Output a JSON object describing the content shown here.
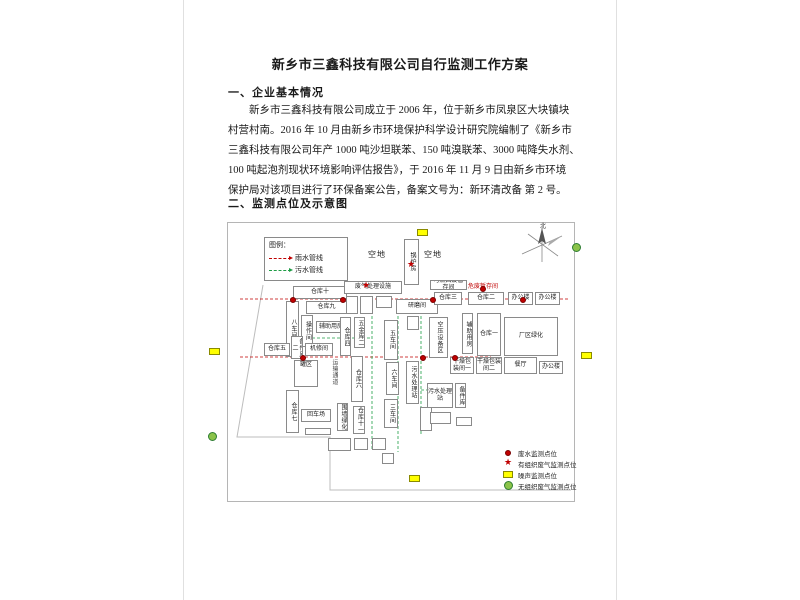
{
  "document": {
    "title": "新乡市三鑫科技有限公司自行监测工作方案",
    "section1_heading": "一、企业基本情况",
    "paragraph_lines": [
      "新乡市三鑫科技有限公司成立于 2006 年，位于新乡市凤泉区大块镇块",
      "村营村南。2016 年 10 月由新乡市环境保护科学设计研究院编制了《新乡市",
      "三鑫科技有限公司年产 1000 吨沙坦联苯、150 吨溴联苯、3000 吨降失水剂、",
      "100 吨起泡剂现状环境影响评估报告》，于 2016 年 11 月 9 日由新乡市环境",
      "保护局对该项目进行了环保备案公告，备案文号为：新环清改备 第 2 号。"
    ],
    "section2_heading": "二、监测点位及示意图"
  },
  "colors": {
    "red": "#c00000",
    "green": "#1f9d46",
    "yellow": "#ffff00",
    "boundary": "#bdbdbd"
  },
  "diagram": {
    "compass_label": "北",
    "pipe_legend": {
      "title": "图例：",
      "items": [
        {
          "color": "red",
          "label": "雨水管线"
        },
        {
          "color": "green",
          "label": "污水管线"
        }
      ]
    },
    "areas": [
      {
        "label": "空地",
        "x": 368,
        "y": 249
      },
      {
        "label": "空地",
        "x": 424,
        "y": 249
      }
    ],
    "red_label": {
      "label": "危废暂存间",
      "x": 468,
      "y": 281
    },
    "buildings": [
      {
        "label": "锅炉房",
        "x": 404,
        "y": 239,
        "w": 15,
        "h": 46,
        "v": 1
      },
      {
        "label": "仓库十",
        "x": 293,
        "y": 286,
        "w": 54,
        "h": 13
      },
      {
        "label": "仓库九",
        "x": 306,
        "y": 301,
        "w": 41,
        "h": 13
      },
      {
        "label": "八车间",
        "x": 286,
        "y": 301,
        "w": 13,
        "h": 56,
        "v": 1
      },
      {
        "label": "操作间",
        "x": 301,
        "y": 315,
        "w": 12,
        "h": 32,
        "v": 1
      },
      {
        "label": "辅助用房",
        "x": 316,
        "y": 321,
        "w": 30,
        "h": 12
      },
      {
        "label": "仓库五",
        "x": 264,
        "y": 343,
        "w": 26,
        "h": 13
      },
      {
        "label": "备件库二",
        "x": 291,
        "y": 336,
        "w": 12,
        "h": 23,
        "v": 1
      },
      {
        "label": "机修间",
        "x": 305,
        "y": 343,
        "w": 28,
        "h": 13
      },
      {
        "label": "罐区",
        "x": 294,
        "y": 360,
        "w": 24,
        "h": 27,
        "tank": 1
      },
      {
        "label": "运输通道",
        "x": 329,
        "y": 352,
        "w": 9,
        "h": 40,
        "v": 1,
        "road": 1
      },
      {
        "label": "仓库六",
        "x": 351,
        "y": 356,
        "w": 12,
        "h": 46,
        "v": 1
      },
      {
        "label": "仓库七",
        "x": 286,
        "y": 390,
        "w": 13,
        "h": 43,
        "v": 1
      },
      {
        "label": "回车场",
        "x": 301,
        "y": 409,
        "w": 30,
        "h": 13
      },
      {
        "label": "围墙绿化",
        "x": 337,
        "y": 403,
        "w": 11,
        "h": 28,
        "v": 1
      },
      {
        "label": "仓库十一",
        "x": 353,
        "y": 406,
        "w": 12,
        "h": 28,
        "v": 1
      },
      {
        "label": "废气处理设施",
        "x": 344,
        "y": 281,
        "w": 58,
        "h": 13
      },
      {
        "label": "",
        "x": 346,
        "y": 296,
        "w": 12,
        "h": 18
      },
      {
        "label": "",
        "x": 360,
        "y": 296,
        "w": 13,
        "h": 18
      },
      {
        "label": "",
        "x": 376,
        "y": 296,
        "w": 16,
        "h": 12
      },
      {
        "label": "研磨间",
        "x": 396,
        "y": 299,
        "w": 42,
        "h": 15
      },
      {
        "label": "",
        "x": 407,
        "y": 316,
        "w": 12,
        "h": 14
      },
      {
        "label": "仓库四",
        "x": 340,
        "y": 317,
        "w": 11,
        "h": 39,
        "v": 1
      },
      {
        "label": "五金库二",
        "x": 354,
        "y": 317,
        "w": 11,
        "h": 31,
        "v": 1
      },
      {
        "label": "五车间",
        "x": 384,
        "y": 320,
        "w": 14,
        "h": 40,
        "v": 1
      },
      {
        "label": "空压设备区",
        "x": 429,
        "y": 317,
        "w": 19,
        "h": 41,
        "v": 1
      },
      {
        "label": "六车间",
        "x": 386,
        "y": 362,
        "w": 13,
        "h": 33,
        "v": 1
      },
      {
        "label": "污水处理站",
        "x": 406,
        "y": 361,
        "w": 13,
        "h": 43,
        "v": 1
      },
      {
        "label": "三车间",
        "x": 384,
        "y": 399,
        "w": 14,
        "h": 29,
        "v": 1
      },
      {
        "label": "",
        "x": 420,
        "y": 407,
        "w": 12,
        "h": 24,
        "v": 1
      },
      {
        "label": "可燃固废暂存间",
        "x": 430,
        "y": 280,
        "w": 37,
        "h": 10
      },
      {
        "label": "仓库三",
        "x": 434,
        "y": 292,
        "w": 28,
        "h": 13
      },
      {
        "label": "仓库二",
        "x": 468,
        "y": 292,
        "w": 36,
        "h": 13
      },
      {
        "label": "办公楼",
        "x": 508,
        "y": 292,
        "w": 25,
        "h": 13
      },
      {
        "label": "办公楼",
        "x": 535,
        "y": 292,
        "w": 25,
        "h": 13
      },
      {
        "label": "辅助用房",
        "x": 462,
        "y": 313,
        "w": 11,
        "h": 41,
        "v": 1
      },
      {
        "label": "仓库一",
        "x": 477,
        "y": 313,
        "w": 24,
        "h": 43
      },
      {
        "label": "厂区绿化",
        "x": 504,
        "y": 317,
        "w": 54,
        "h": 39
      },
      {
        "label": "干燥包装间一",
        "x": 450,
        "y": 357,
        "w": 24,
        "h": 17
      },
      {
        "label": "干燥包装间二",
        "x": 476,
        "y": 357,
        "w": 26,
        "h": 17
      },
      {
        "label": "餐厅",
        "x": 504,
        "y": 357,
        "w": 33,
        "h": 17
      },
      {
        "label": "办公楼",
        "x": 539,
        "y": 361,
        "w": 24,
        "h": 13
      },
      {
        "label": "污水处理站",
        "x": 427,
        "y": 383,
        "w": 26,
        "h": 25
      },
      {
        "label": "备件库",
        "x": 455,
        "y": 383,
        "w": 11,
        "h": 25,
        "v": 1
      },
      {
        "label": "",
        "x": 430,
        "y": 412,
        "w": 21,
        "h": 12
      },
      {
        "label": "",
        "x": 456,
        "y": 417,
        "w": 16,
        "h": 9
      },
      {
        "label": "",
        "x": 305,
        "y": 428,
        "w": 26,
        "h": 7
      },
      {
        "label": "",
        "x": 328,
        "y": 438,
        "w": 23,
        "h": 13
      },
      {
        "label": "",
        "x": 354,
        "y": 438,
        "w": 14,
        "h": 12
      },
      {
        "label": "",
        "x": 372,
        "y": 438,
        "w": 14,
        "h": 12
      },
      {
        "label": "",
        "x": 382,
        "y": 453,
        "w": 12,
        "h": 11
      }
    ],
    "boundary": [
      [
        263,
        285
      ],
      [
        237,
        437
      ],
      [
        330,
        437
      ],
      [
        330,
        490
      ],
      [
        571,
        490
      ]
    ],
    "pipes": [
      {
        "color": "red",
        "pts": [
          [
            240,
            299
          ],
          [
            568,
            299
          ]
        ]
      },
      {
        "color": "red",
        "pts": [
          [
            240,
            357
          ],
          [
            491,
            357
          ]
        ]
      },
      {
        "color": "green",
        "pts": [
          [
            372,
            306
          ],
          [
            372,
            449
          ]
        ]
      },
      {
        "color": "green",
        "pts": [
          [
            398,
            306
          ],
          [
            398,
            452
          ]
        ]
      },
      {
        "color": "green",
        "pts": [
          [
            421,
            306
          ],
          [
            421,
            436
          ]
        ]
      },
      {
        "color": "green",
        "pts": [
          [
            312,
            338
          ],
          [
            372,
            338
          ]
        ]
      },
      {
        "color": "green",
        "pts": [
          [
            421,
            390
          ],
          [
            427,
            390
          ]
        ]
      }
    ],
    "markers": [
      {
        "t": "rect",
        "x": 417,
        "y": 229
      },
      {
        "t": "rect",
        "x": 209,
        "y": 348
      },
      {
        "t": "rect",
        "x": 581,
        "y": 352
      },
      {
        "t": "rect",
        "x": 409,
        "y": 475
      },
      {
        "t": "circle",
        "x": 572,
        "y": 243
      },
      {
        "t": "circle",
        "x": 208,
        "y": 432
      },
      {
        "t": "star",
        "x": 361,
        "y": 282
      },
      {
        "t": "star",
        "x": 406,
        "y": 261
      },
      {
        "t": "dot",
        "x": 480,
        "y": 286
      },
      {
        "t": "dot",
        "x": 452,
        "y": 355
      },
      {
        "t": "dot",
        "x": 290,
        "y": 297
      },
      {
        "t": "dot",
        "x": 340,
        "y": 297
      },
      {
        "t": "dot",
        "x": 430,
        "y": 297
      },
      {
        "t": "dot",
        "x": 520,
        "y": 297
      },
      {
        "t": "dot",
        "x": 300,
        "y": 355
      },
      {
        "t": "dot",
        "x": 420,
        "y": 355
      }
    ],
    "marker_legend": [
      {
        "t": "dot",
        "label": "废水监测点位"
      },
      {
        "t": "star",
        "label": "有组织废气监测点位"
      },
      {
        "t": "rect",
        "label": "噪声监测点位"
      },
      {
        "t": "circle",
        "label": "无组织废气监测点位"
      }
    ]
  }
}
